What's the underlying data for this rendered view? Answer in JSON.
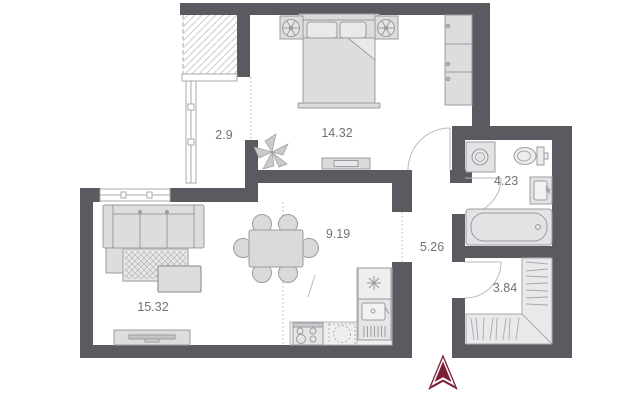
{
  "plan": {
    "rooms": [
      {
        "name": "balcony",
        "area": "2.9"
      },
      {
        "name": "bedroom",
        "area": "14.32"
      },
      {
        "name": "living-room",
        "area": "15.32"
      },
      {
        "name": "kitchen-dining",
        "area": "9.19"
      },
      {
        "name": "hallway",
        "area": "5.26"
      },
      {
        "name": "bathroom",
        "area": "4.23"
      },
      {
        "name": "walk-in-closet",
        "area": "3.84"
      }
    ],
    "colors": {
      "wall": "#595b60",
      "furniture_fill": "#dcdddd",
      "furniture_stroke": "#9b9c9f",
      "room_fill": "#ffffff",
      "label_text": "#717275",
      "north_arrow": "#7b2135",
      "hatch": "#c9cacc",
      "dotted_divider": "#bcbdbf"
    },
    "icons": {
      "north_arrow": "north-arrow-icon",
      "plant": "plant-icon"
    }
  }
}
